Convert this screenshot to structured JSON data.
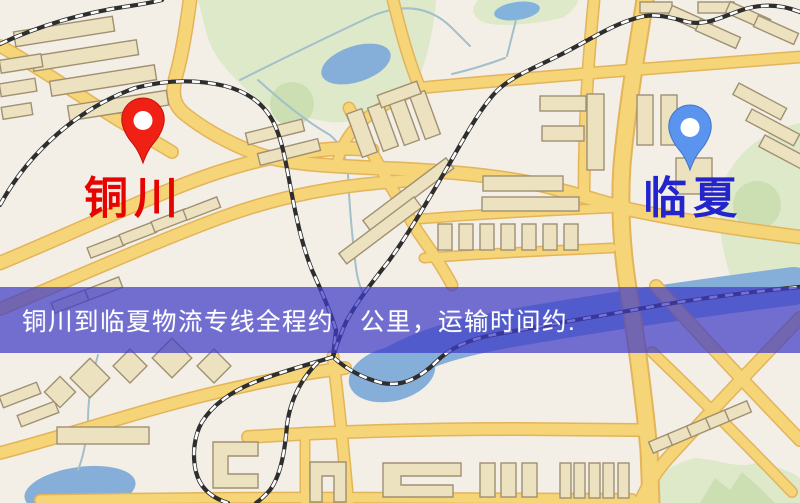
{
  "banner": {
    "text": "铜川到临夏物流专线全程约　公里，运输时间约.",
    "background_color": "rgba(62,60,198,0.72)",
    "text_color": "#ffffff"
  },
  "markers": [
    {
      "id": "origin",
      "label": "铜川",
      "label_color": "#e60400",
      "pin_color": "#f02015",
      "pin_edge": "#c01008"
    },
    {
      "id": "destination",
      "label": "临夏",
      "label_color": "#2424cc",
      "pin_color": "#5b94ee",
      "pin_edge": "#3f74cc"
    }
  ],
  "map_colors": {
    "background": "#f3efe6",
    "road": "#f6d478",
    "road_casing": "#e3b45a",
    "park": "#dde9c9",
    "water": "#85aed8",
    "railway": "#2e2e2e",
    "building": "#ece2c0"
  }
}
